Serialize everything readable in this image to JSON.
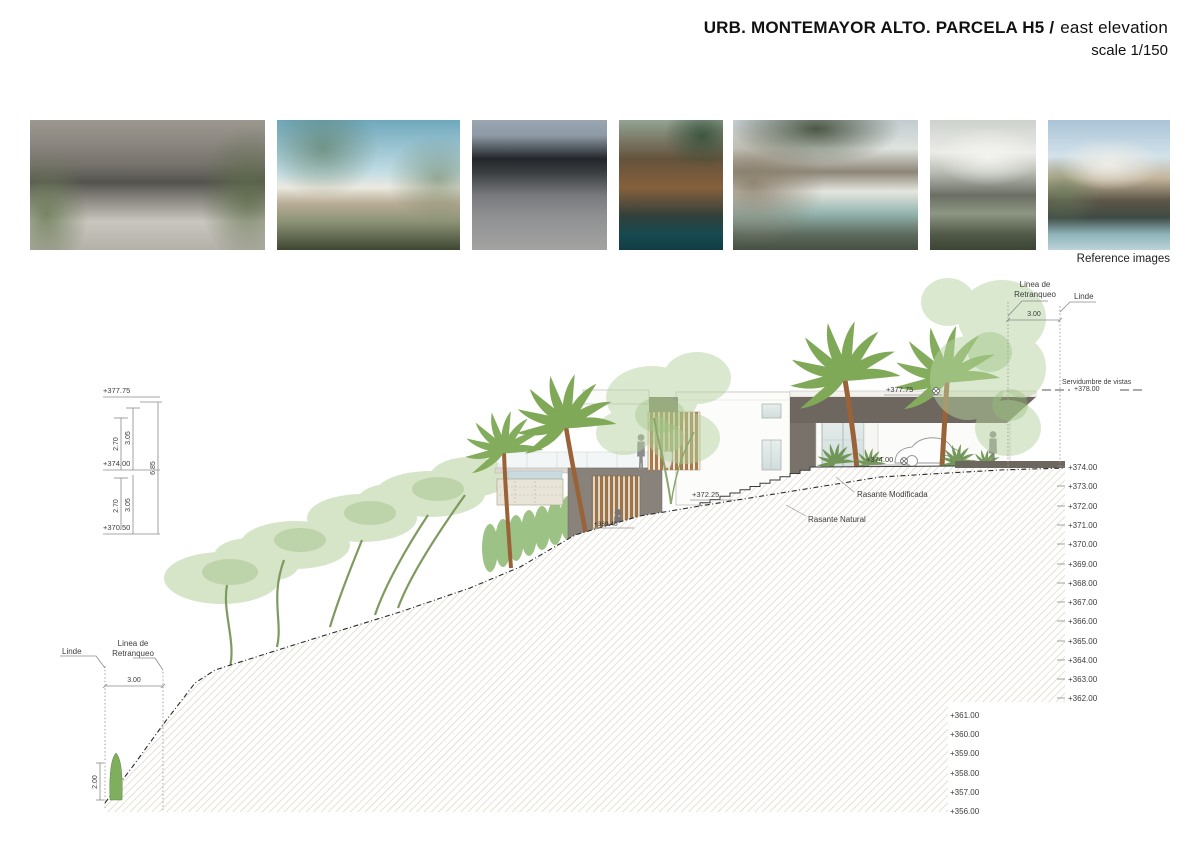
{
  "header": {
    "project": "URB. MONTEMAYOR ALTO. PARCELA H5 /",
    "view": "east elevation",
    "scale_note": "scale 1/150"
  },
  "reference_strip": {
    "caption": "Reference images"
  },
  "levels_scale": {
    "upper": [
      "+374.00",
      "+373.00",
      "+372.00",
      "+371.00",
      "+370.00",
      "+369.00",
      "+368.00",
      "+367.00",
      "+366.00",
      "+365.00",
      "+364.00",
      "+363.00",
      "+362.00"
    ],
    "lower": [
      "+361.00",
      "+360.00",
      "+359.00",
      "+358.00",
      "+357.00",
      "+356.00"
    ]
  },
  "left_column": {
    "levels": [
      "+377.75",
      "+374.00",
      "+370.50"
    ],
    "dims": {
      "upper_inner": "2.70",
      "upper_outer": "3.05",
      "total": "6.85",
      "lower_inner": "2.70",
      "lower_outer": "3.05"
    }
  },
  "boundaries": {
    "top": {
      "setback_label_1": "Linea de",
      "setback_label_2": "Retranqueo",
      "property_line": "Linde",
      "setback_dim": "3.00",
      "easement": "Servidumbre de vistas",
      "easement_level": "+378.00"
    },
    "bottom": {
      "property_line": "Linde",
      "setback_label_1": "Linea de",
      "setback_label_2": "Retranqueo",
      "setback_dim": "3.00",
      "tree_height_dim": "2.00"
    }
  },
  "grades": {
    "modified": "Rasante Modificada",
    "natural": "Rasante Natural"
  },
  "spot_levels": {
    "roof": "+377.75",
    "driveway": "+374.00",
    "terrace": "+372.25",
    "lower_floor": "+369.40"
  }
}
